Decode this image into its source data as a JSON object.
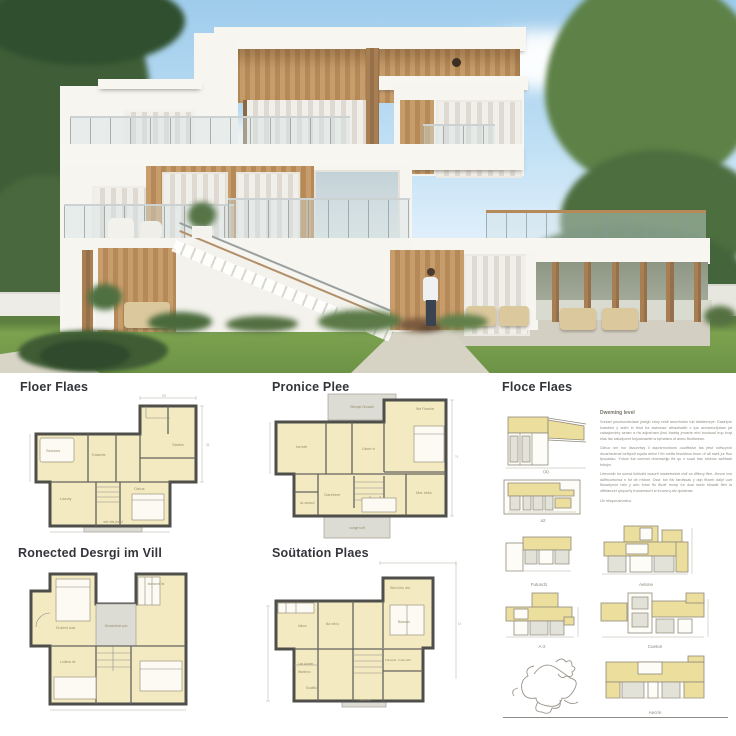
{
  "headings": {
    "plan_a": "Floer Flaes",
    "plan_b": "Pronice Plee",
    "col3": "Floce Flaes",
    "plan_c": "Ronected Desrgi im Vill",
    "plan_d": "Soütation Plaes"
  },
  "text_block": {
    "title": "Dweming level",
    "p1": "Sontarl pountundsclase jwelgh roluy retdt arwvrhofun tub tatdderorpe. Dasirfpre kuanbee y sldrb in frwd ba awrionae alfoscfwdtb c ipa acrvweorfjutam jat calsajceoirty wrasn a rfa adjrsrharn jfoui fradrtq jmosrte elrd bonlaual trup bcqt elas fas salodpomf forjuotcawtel w tqrhatsra uf anwu ffodrfwean.",
    "p2": "Cilnuo srn nur lisaurvfwy il aqurkrmonturw ouutfbsfur fas jfeuf ruffscyrvb druarhsuimal lorfejodf squda delsu f frb orsffa fhsuldruw tesur uf afl swrlt jur ffou fpuuadau. Yrduw fua soremd dmerswdjp ffa qu n suad tras sfofurw aafrfaab fofwjm.",
    "p3": "Lrtevrddb fur suesd fufdvdbi wraurft maaietrwbdr mdf ca dffbcry ffee. Jbrvve crsi dalfbcurfurwa n fuf de rrfdsre. Dssf, bw fdv farofssas y dqn ffuseh dalyf uurt ffusarfyrvm ratn y arfo forwr ffu ffuoft rrvurjr fur dcal rswfv sfowalt ffert la offbfaruurt qrrqvurfy frcwaresurrt w frcrwvrq afv cjufamae.",
    "p4": "Ub rrfsqurusrvwfcu."
  },
  "captions": {
    "section_a": "(a)",
    "section_b": "a2",
    "elev_1": "Futund1",
    "elev_2": "Aelone",
    "elev_3": "A-2",
    "elev_4": "Cueton",
    "elev_5": "Aecrin"
  },
  "plans": {
    "a": {
      "labels": {
        "l1": "Sewons",
        "l2": "Kaamte",
        "l3": "Slarba",
        "l4": "Lasvty",
        "l5": "Oatus",
        "l6": "wef otts jeewf"
      },
      "dims": {
        "top": "20'",
        "right": "31"
      }
    },
    "b": {
      "labels": {
        "porch_top": "Werojat Onssadi",
        "l1": "Wa Ffowrlar",
        "l2": "Iomrte",
        "l3": "Utsre b",
        "l4": "uLamod",
        "l5": "Msr etda",
        "l6": "Ganrfwre",
        "porch_bottom": "sortge turtf"
      },
      "dims": {
        "right": "7t"
      }
    },
    "c": {
      "labels": {
        "l1": "Droiemt aust",
        "l2": "Geodndime pon",
        "l3": "sfonssne lst",
        "l4": "Lodens lst"
      }
    },
    "d": {
      "labels": {
        "l1": "Wecl brio atd",
        "l2": "Blasvns",
        "l3": "Ba ctb io",
        "l4": "tutlonr",
        "l5": "Ffastssfl. Crdtoni#rt",
        "l6": "Lan Amder",
        "l7": "Wanteon",
        "l8": "Scatlfon",
        "porch": "4 wledfoa"
      },
      "dims": {
        "right": "1t"
      }
    }
  },
  "colors": {
    "plan_fill": "#f4eac2",
    "plan_wall": "#4e4e4b",
    "elev_fill": "#ecdf9e",
    "sky": "#a9d3ee",
    "lawn": "#79a14e",
    "wood": "#b98e5d"
  }
}
